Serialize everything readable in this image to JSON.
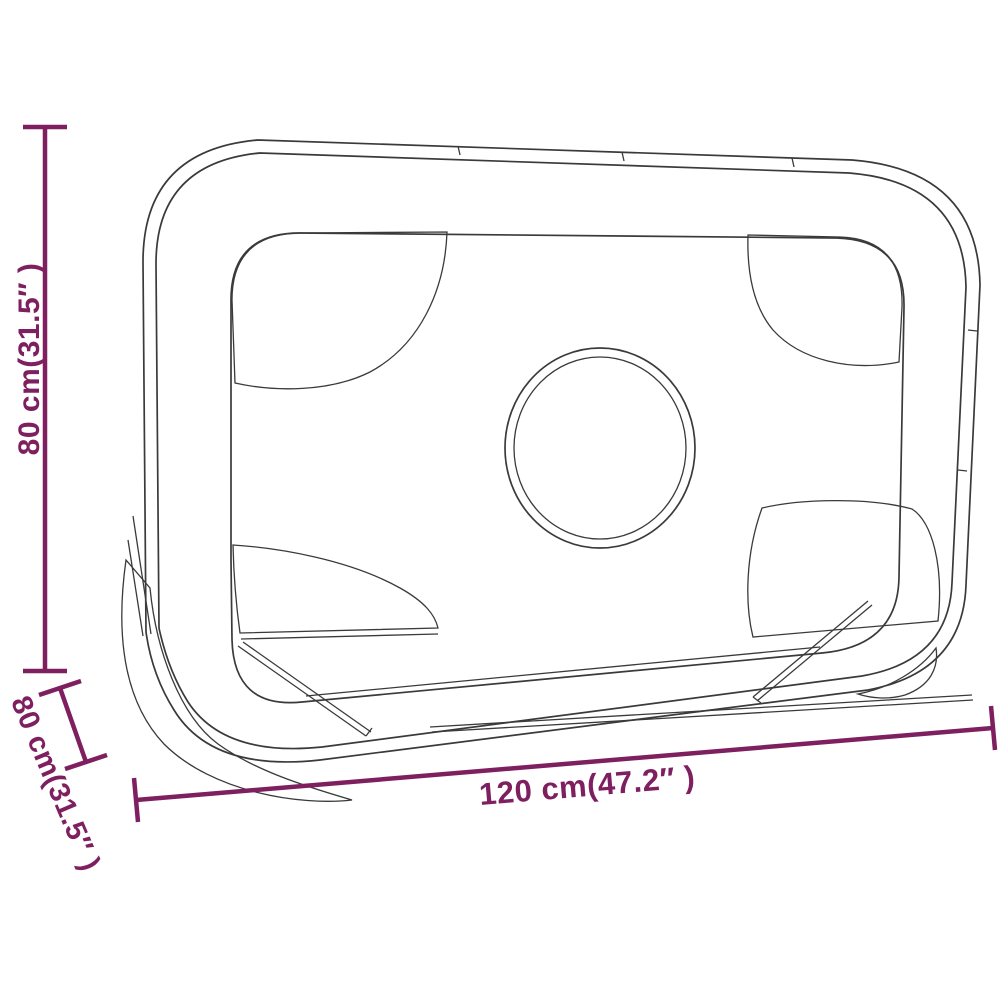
{
  "diagram": {
    "style": {
      "dimension_color": "#7E1F5F",
      "line_art_color": "#3A3A3A",
      "background": "#FFFFFF"
    },
    "dimensions": {
      "height": {
        "label": "80 cm(31.5″ )",
        "value_cm": 80,
        "value_inch": 31.5
      },
      "depth": {
        "label": "80 cm(31.5″ )",
        "value_cm": 80,
        "value_inch": 31.5
      },
      "width": {
        "label": "120 cm(47.2″ )",
        "value_cm": 120,
        "value_inch": 47.2
      }
    }
  }
}
